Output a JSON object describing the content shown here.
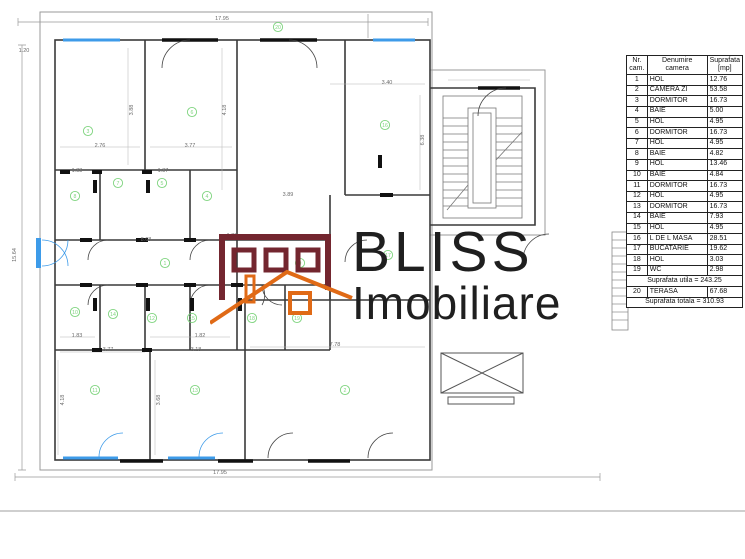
{
  "logo": {
    "line1": "BLISS",
    "line2": "Imobiliare",
    "brand_maroon": "#73262f",
    "brand_orange": "#e06a16",
    "text_color": "#1f1f1f"
  },
  "table": {
    "col_headers": [
      "Nr. cam.",
      "Denumire camera",
      "Suprafata [mp]"
    ],
    "rows": [
      [
        "1",
        "HOL",
        "12.76"
      ],
      [
        "2",
        "CAMERA ZI",
        "53.58"
      ],
      [
        "3",
        "DORMITOR",
        "16.73"
      ],
      [
        "4",
        "BAIE",
        "5.00"
      ],
      [
        "5",
        "HOL",
        "4.95"
      ],
      [
        "6",
        "DORMITOR",
        "16.73"
      ],
      [
        "7",
        "HOL",
        "4.95"
      ],
      [
        "8",
        "BAIE",
        "4.82"
      ],
      [
        "9",
        "HOL",
        "13.46"
      ],
      [
        "10",
        "BAIE",
        "4.84"
      ],
      [
        "11",
        "DORMITOR",
        "16.73"
      ],
      [
        "12",
        "HOL",
        "4.95"
      ],
      [
        "13",
        "DORMITOR",
        "16.73"
      ],
      [
        "14",
        "BAIE",
        "7.93"
      ],
      [
        "15",
        "HOL",
        "4.95"
      ],
      [
        "16",
        "L DE L MASA",
        "28.51"
      ],
      [
        "17",
        "BUCATARIE",
        "19.62"
      ],
      [
        "18",
        "HOL",
        "3.03"
      ],
      [
        "19",
        "WC",
        "2.98"
      ]
    ],
    "subtotal_label": "Suprafata utila = 243.25",
    "terasa_row": [
      "20",
      "TERASA",
      "67.68"
    ],
    "total_label": "Suprafata totala = 310.93"
  },
  "plan": {
    "colors": {
      "wall": "#3a3a3a",
      "light": "#9a9a9a",
      "window_blue": "#3d9be9",
      "marker_green": "#7fd47f",
      "dim_text": "#6a6a6a"
    },
    "room_markers": [
      {
        "n": "20",
        "x": 278,
        "y": 27
      },
      {
        "n": "3",
        "x": 88,
        "y": 131
      },
      {
        "n": "6",
        "x": 192,
        "y": 112
      },
      {
        "n": "16",
        "x": 385,
        "y": 125
      },
      {
        "n": "8",
        "x": 75,
        "y": 196
      },
      {
        "n": "7",
        "x": 118,
        "y": 183
      },
      {
        "n": "5",
        "x": 162,
        "y": 183
      },
      {
        "n": "4",
        "x": 207,
        "y": 196
      },
      {
        "n": "1",
        "x": 165,
        "y": 263
      },
      {
        "n": "9",
        "x": 300,
        "y": 263
      },
      {
        "n": "10",
        "x": 75,
        "y": 312
      },
      {
        "n": "14",
        "x": 113,
        "y": 314
      },
      {
        "n": "12",
        "x": 152,
        "y": 318
      },
      {
        "n": "15",
        "x": 192,
        "y": 318
      },
      {
        "n": "18",
        "x": 252,
        "y": 318
      },
      {
        "n": "19",
        "x": 297,
        "y": 318
      },
      {
        "n": "17",
        "x": 388,
        "y": 255
      },
      {
        "n": "11",
        "x": 95,
        "y": 390
      },
      {
        "n": "13",
        "x": 195,
        "y": 390
      },
      {
        "n": "2",
        "x": 345,
        "y": 390
      }
    ],
    "dim_labels": [
      {
        "t": "17.95",
        "x": 222,
        "y": 20
      },
      {
        "t": "1.20",
        "x": 24,
        "y": 52
      },
      {
        "t": "15.64",
        "x": 16,
        "y": 255,
        "r": -90
      },
      {
        "t": "17.95",
        "x": 220,
        "y": 474
      },
      {
        "t": "2.76",
        "x": 100,
        "y": 147
      },
      {
        "t": "3.77",
        "x": 190,
        "y": 147
      },
      {
        "t": "3.88",
        "x": 133,
        "y": 110,
        "r": -90
      },
      {
        "t": "4.18",
        "x": 226,
        "y": 110,
        "r": -90
      },
      {
        "t": "3.40",
        "x": 387,
        "y": 84
      },
      {
        "t": "6.38",
        "x": 424,
        "y": 140,
        "r": -90
      },
      {
        "t": "1.83",
        "x": 77,
        "y": 172
      },
      {
        "t": "1.87",
        "x": 163,
        "y": 172
      },
      {
        "t": "8.68",
        "x": 146,
        "y": 241
      },
      {
        "t": "1.80",
        "x": 232,
        "y": 237
      },
      {
        "t": "1.83",
        "x": 77,
        "y": 337
      },
      {
        "t": "1.82",
        "x": 200,
        "y": 337
      },
      {
        "t": "3.77",
        "x": 108,
        "y": 351
      },
      {
        "t": "3.18",
        "x": 196,
        "y": 351
      },
      {
        "t": "4.18",
        "x": 64,
        "y": 400,
        "r": -90
      },
      {
        "t": "3.68",
        "x": 160,
        "y": 400,
        "r": -90
      },
      {
        "t": "7.78",
        "x": 335,
        "y": 346
      },
      {
        "t": "3.89",
        "x": 288,
        "y": 196
      }
    ]
  }
}
